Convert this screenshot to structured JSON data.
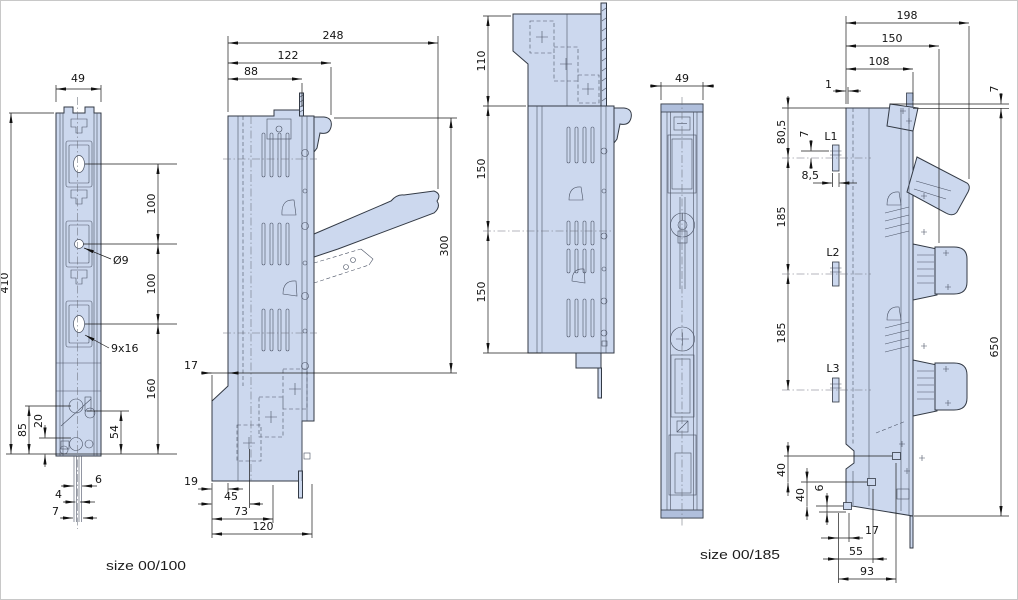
{
  "drawing": {
    "units": "mm",
    "colors": {
      "body_fill": "#ccd8ee",
      "outline": "#333a45",
      "dim_line": "#1c1c1c",
      "background": "#ffffff"
    },
    "views": {
      "front_00_100": {
        "caption": "size 00/100",
        "width": "49",
        "height": "410",
        "pitch_top": "100",
        "pitch_mid": "100",
        "pitch_bottom": "160",
        "base_height": "54",
        "hole_offset": "85",
        "slot_offset": "20",
        "pin_width": "6",
        "pin_inner": "4",
        "pin_outer": "7",
        "hole_label": "Ø9",
        "slot_label": "9x16"
      },
      "side_00_100": {
        "depth_total": "248",
        "depth_mid": "122",
        "depth_front": "88",
        "height": "300",
        "foot_offset": "17",
        "base_offset": "19",
        "base_step1": "45",
        "base_step2": "73",
        "base_depth": "120"
      },
      "side_rotated": {
        "seg_top": "110",
        "seg_mid": "150",
        "seg_bottom": "150"
      },
      "front_00_185": {
        "width": "49",
        "caption": "size 00/185"
      },
      "side_00_185": {
        "depth_total": "198",
        "depth_mid": "150",
        "depth_front": "108",
        "edge_offset": "1",
        "top_offset": "7",
        "top_to_l1": "80,5",
        "l1_offset": "7",
        "stud_offset": "8,5",
        "terminal_1": "L1",
        "terminal_2": "L2",
        "terminal_3": "L3",
        "pitch_a": "185",
        "pitch_b": "185",
        "height": "650",
        "base_a": "40",
        "base_b": "40",
        "base_c": "6",
        "base_x1": "17",
        "base_x2": "55",
        "base_x3": "93"
      }
    }
  }
}
